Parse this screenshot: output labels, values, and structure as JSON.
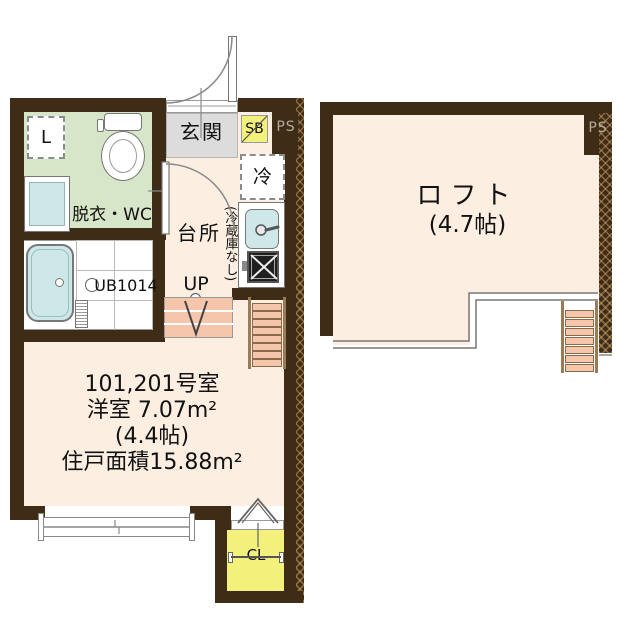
{
  "colors": {
    "wall": "#3e2c17",
    "floor": "#fcefe2",
    "wc_room_green": "#d7e6c8",
    "entrance_gray": "#dcdcdc",
    "closet_yellow": "#f3f07c",
    "water_blue": "#cee8ea",
    "stair_salmon": "#f5c6ab"
  },
  "unit": {
    "entrance_label": "玄関",
    "shoebox_label": "SB",
    "ps_label": "PS",
    "laundry_label": "L",
    "wc_label": "脱衣・WC",
    "bath_label": "UB1014",
    "kitchen_label": "台所",
    "fridge_label": "冷",
    "fridge_note": "(冷蔵庫なし)",
    "up_label": "UP",
    "room_info": [
      "101,201号室",
      "洋室 7.07m²",
      "(4.4帖)",
      "住戸面積15.88m²"
    ],
    "closet_label": "CL"
  },
  "loft": {
    "label": "ロフト",
    "size": "(4.7帖)",
    "ps_label": "PS"
  }
}
